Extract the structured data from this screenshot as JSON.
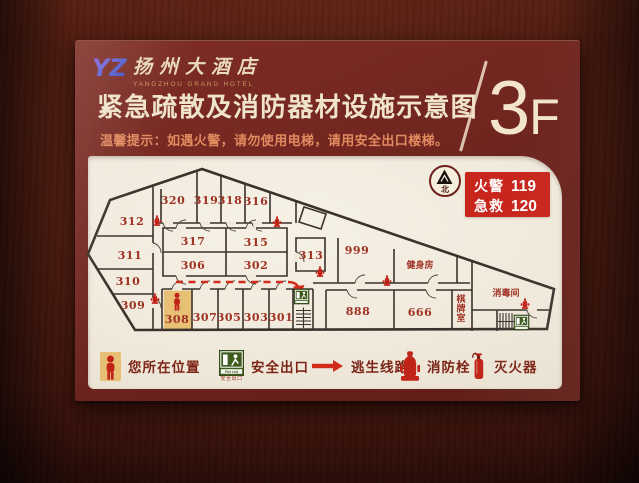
{
  "header": {
    "logo_mark": "YZ",
    "hotel_name_cn": "扬州大酒店",
    "hotel_name_en": "YANGZHOU GRAND HOTEL",
    "title": "紧急疏散及消防器材设施示意图",
    "subtitle": "温馨提示：如遇火警，请勿使用电梯，请用安全出口楼梯。",
    "floor_number": "3",
    "floor_suffix": "F"
  },
  "info_box": {
    "lines": [
      {
        "label": "火警",
        "number": "119"
      },
      {
        "label": "急救",
        "number": "120"
      }
    ]
  },
  "compass": {
    "north_label": "北"
  },
  "floor_plan": {
    "rooms": [
      {
        "label": "320",
        "x": 173,
        "y": 203
      },
      {
        "label": "319",
        "x": 206,
        "y": 203
      },
      {
        "label": "318",
        "x": 230,
        "y": 203
      },
      {
        "label": "316",
        "x": 256,
        "y": 204
      },
      {
        "label": "312",
        "x": 132,
        "y": 224
      },
      {
        "label": "311",
        "x": 130,
        "y": 258
      },
      {
        "label": "310",
        "x": 128,
        "y": 284
      },
      {
        "label": "309",
        "x": 133,
        "y": 308
      },
      {
        "label": "317",
        "x": 193,
        "y": 244
      },
      {
        "label": "315",
        "x": 256,
        "y": 245
      },
      {
        "label": "306",
        "x": 193,
        "y": 268
      },
      {
        "label": "302",
        "x": 256,
        "y": 268
      },
      {
        "label": "313",
        "x": 311,
        "y": 258
      },
      {
        "label": "999",
        "x": 357,
        "y": 253
      },
      {
        "label": "健身房",
        "x": 420,
        "y": 267,
        "small": true
      },
      {
        "label": "308",
        "x": 177,
        "y": 322
      },
      {
        "label": "307",
        "x": 205,
        "y": 320
      },
      {
        "label": "305",
        "x": 229,
        "y": 320
      },
      {
        "label": "303",
        "x": 256,
        "y": 320
      },
      {
        "label": "301",
        "x": 281,
        "y": 320
      },
      {
        "label": "888",
        "x": 358,
        "y": 314
      },
      {
        "label": "666",
        "x": 420,
        "y": 315
      },
      {
        "label": "棋牌室",
        "x": 461,
        "y": 301,
        "small": true,
        "vertical": true
      },
      {
        "label": "消毒间",
        "x": 506,
        "y": 295,
        "small": true
      }
    ],
    "fire_hydrants": [
      [
        157,
        220
      ],
      [
        277,
        221
      ],
      [
        320,
        271
      ],
      [
        387,
        280
      ],
      [
        155,
        298
      ],
      [
        525,
        303
      ]
    ],
    "exit_signs": [
      [
        294,
        288
      ],
      [
        514,
        314
      ]
    ],
    "you_are_here": {
      "room": "308",
      "x": 177,
      "y": 301,
      "highlight_rect": [
        163.8,
        289.5,
        27.5,
        38.5
      ]
    },
    "escape_route": {
      "dash": "M176,281 H288",
      "solid": "M288,281 Q296,281 298,286",
      "arrow_points": "293,285.5 304.5,284 299.5,296"
    }
  },
  "legend": {
    "items": [
      {
        "icon": "you-are-here-icon",
        "label": "您所在位置"
      },
      {
        "icon": "safe-exit-icon",
        "label": "安全出口",
        "inner_text": "Fire exit",
        "sub_label": "安全出口"
      },
      {
        "icon": "escape-route-arrow-icon",
        "label": "逃生线路"
      },
      {
        "icon": "fire-hydrant-icon",
        "label": "消防栓"
      },
      {
        "icon": "fire-extinguisher-icon",
        "label": "灭火器"
      }
    ]
  },
  "colors": {
    "sign_maroon": "#712520",
    "panel_cream": "#f0e9db",
    "accent_red": "#c8251c",
    "room_label_red": "#9e3122",
    "route_red": "#d22b1b",
    "exit_green": "#3f5c1e",
    "highlight_tan": "#e7c076",
    "wall_ink": "#3b322b",
    "title_cream": "#f0e3cb",
    "subtitle_salmon": "#e08a5f"
  }
}
